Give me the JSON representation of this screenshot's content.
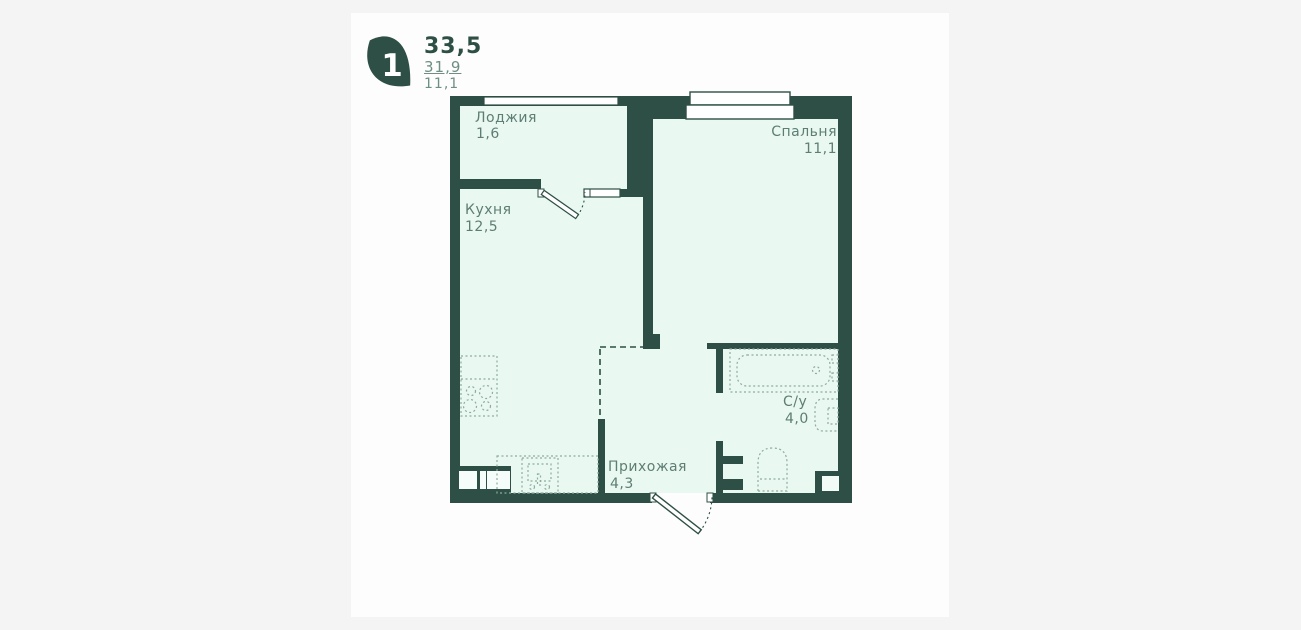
{
  "header": {
    "badge": "1",
    "area_total": "33,5",
    "area_living": "31,9",
    "area_kitchen": "11,1"
  },
  "rooms": {
    "loggia": {
      "name": "Лоджия",
      "area": "1,6"
    },
    "kitchen": {
      "name": "Кухня",
      "area": "12,5"
    },
    "bedroom": {
      "name": "Спальня",
      "area": "11,1"
    },
    "hallway": {
      "name": "Прихожая",
      "area": "4,3"
    },
    "bathroom": {
      "name": "С/у",
      "area": "4,0"
    }
  },
  "colors": {
    "wall": "#2e4f45",
    "room_fill": "#e9f8f1",
    "fixture_dots": "#8fab9f",
    "room_label": "#5e7e74",
    "card_bg": "#fdfdfd",
    "page_bg": "#f4f4f5",
    "logo": "#2e4f45"
  }
}
